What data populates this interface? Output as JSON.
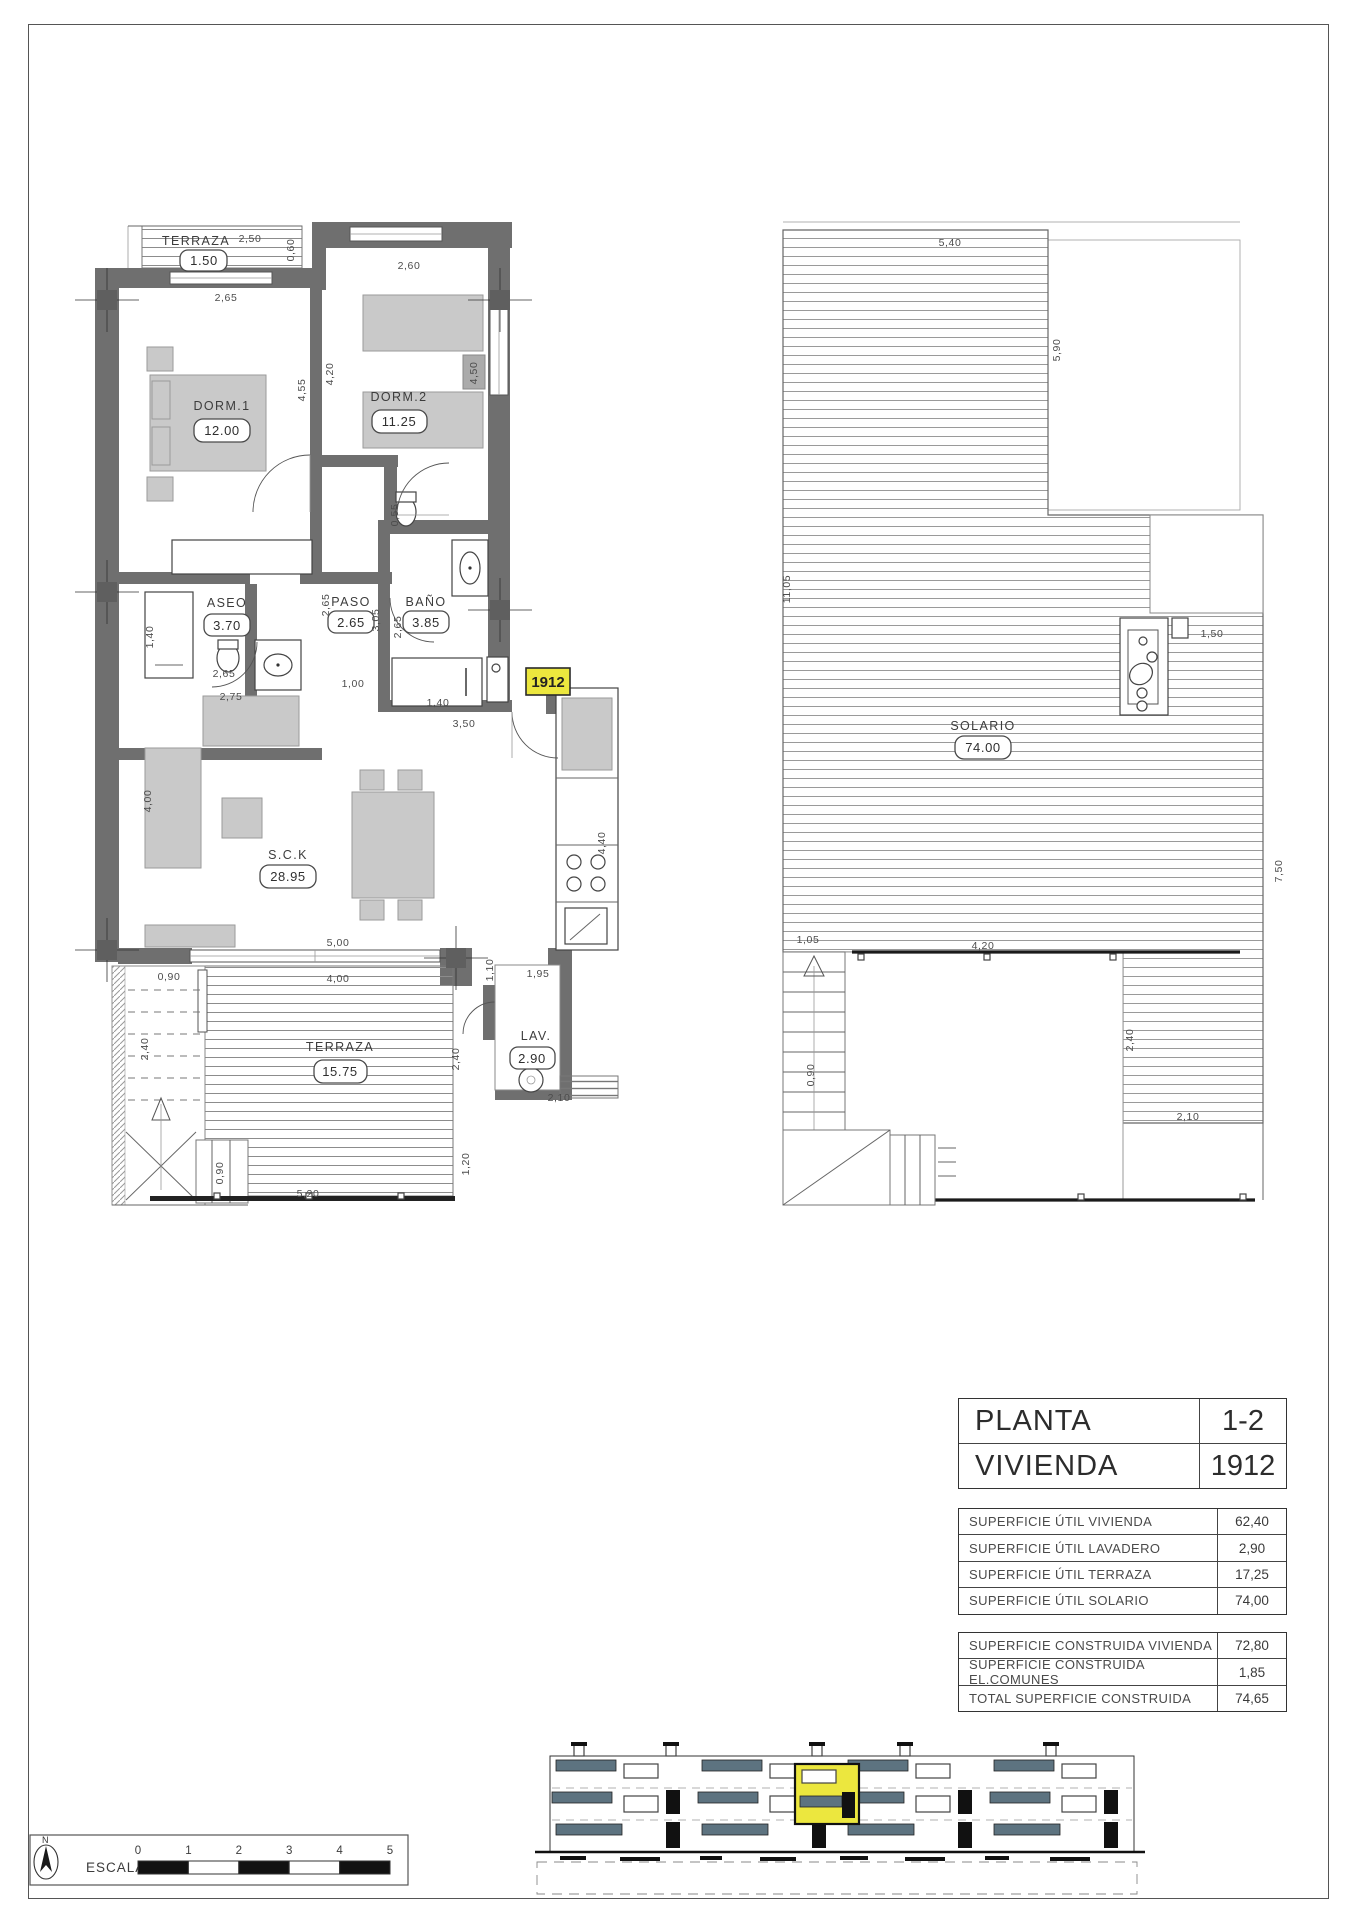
{
  "unit_tag": "1912",
  "compass": {
    "label": "N"
  },
  "scale": {
    "label": "ESCALA :",
    "ticks": [
      "0",
      "1",
      "2",
      "3",
      "4",
      "5"
    ]
  },
  "header_table": {
    "rows": [
      {
        "label": "PLANTA",
        "value": "1-2"
      },
      {
        "label": "VIVIENDA",
        "value": "1912"
      }
    ]
  },
  "areas_util": [
    {
      "label": "SUPERFICIE ÚTIL VIVIENDA",
      "value": "62,40"
    },
    {
      "label": "SUPERFICIE ÚTIL LAVADERO",
      "value": "2,90"
    },
    {
      "label": "SUPERFICIE ÚTIL TERRAZA",
      "value": "17,25"
    },
    {
      "label": "SUPERFICIE ÚTIL SOLARIO",
      "value": "74,00"
    }
  ],
  "areas_constr": [
    {
      "label": "SUPERFICIE CONSTRUIDA VIVIENDA",
      "value": "72,80"
    },
    {
      "label": "SUPERFICIE CONSTRUIDA EL.COMUNES",
      "value": "1,85"
    },
    {
      "label": "TOTAL SUPERFICIE CONSTRUIDA",
      "value": "74,65"
    }
  ],
  "plan_left": {
    "rooms": {
      "terraza_top": {
        "name": "TERRAZA",
        "area": "1.50"
      },
      "dorm1": {
        "name": "DORM.1",
        "area": "12.00"
      },
      "dorm2": {
        "name": "DORM.2",
        "area": "11.25"
      },
      "aseo": {
        "name": "ASEO",
        "area": "3.70"
      },
      "paso": {
        "name": "PASO",
        "area": "2.65"
      },
      "bano": {
        "name": "BAÑO",
        "area": "3.85"
      },
      "sck": {
        "name": "S.C.K",
        "area": "28.95"
      },
      "terraza": {
        "name": "TERRAZA",
        "area": "15.75"
      },
      "lav": {
        "name": "LAV.",
        "area": "2.90"
      }
    },
    "dims": [
      "2,50",
      "0,60",
      "2,65",
      "2,60",
      "4,55",
      "4,20",
      "4,50",
      "0,55",
      "1,40",
      "2,65",
      "2,65",
      "3,05",
      "2,65",
      "1,00",
      "2,75",
      "1,40",
      "3,50",
      "4,00",
      "5,00",
      "4,00",
      "0,90",
      "1,10",
      "1,95",
      "4,40",
      "2,40",
      "2,40",
      "2,10",
      "0,90",
      "5,20",
      "1,20"
    ]
  },
  "plan_right": {
    "room": {
      "name": "SOLARIO",
      "area": "74.00"
    },
    "dims": [
      "5,40",
      "11,05",
      "5,90",
      "1,50",
      "7,50",
      "1,05",
      "4,20",
      "0,90",
      "2,40",
      "2,10"
    ]
  }
}
